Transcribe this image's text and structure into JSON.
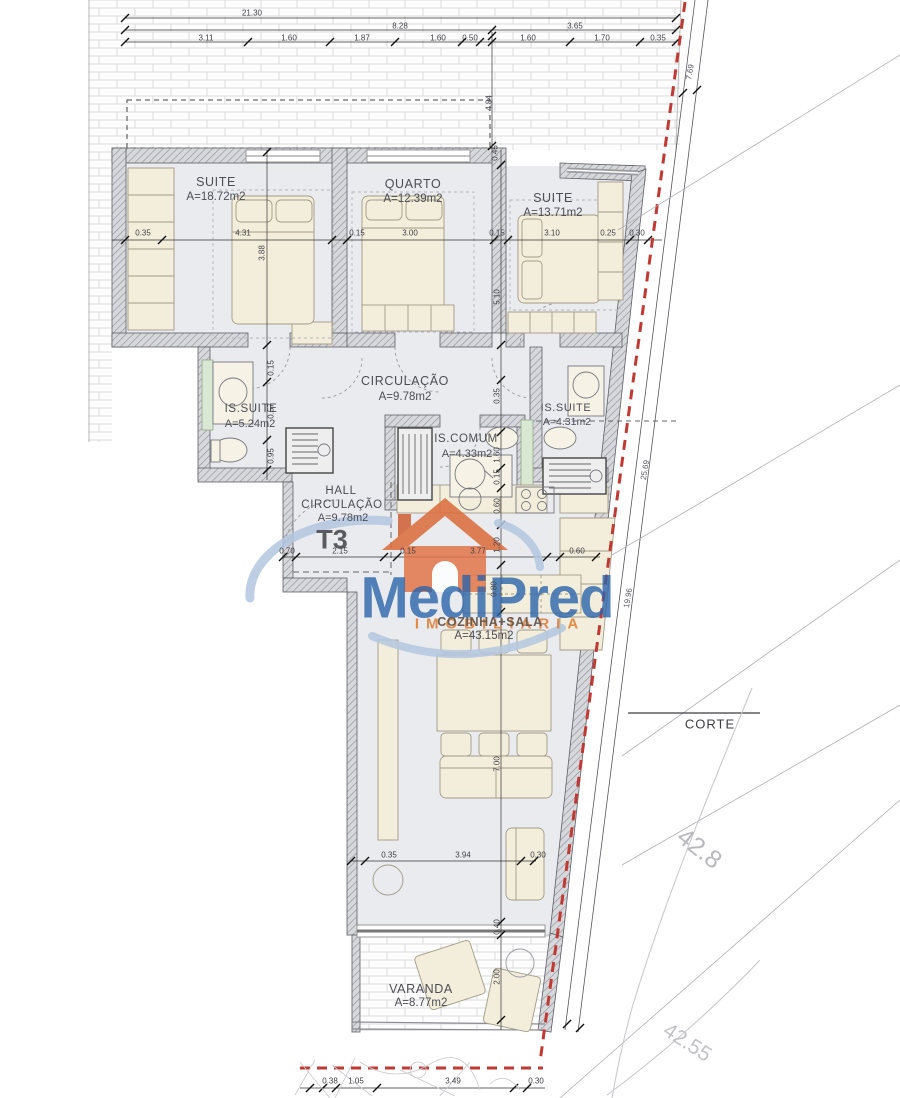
{
  "logo": {
    "name": "MediPred",
    "subtitle": "IMOBILIARIA"
  },
  "rooms": {
    "suite1": {
      "name": "SUITE",
      "area": "A=18.72m2"
    },
    "quarto": {
      "name": "QUARTO",
      "area": "A=12.39m2"
    },
    "suite2": {
      "name": "SUITE",
      "area": "A=13.71m2"
    },
    "circulacao": {
      "name": "CIRCULAÇÃO",
      "area": "A=9.78m2"
    },
    "is_suite1": {
      "name": "IS.SUITE",
      "area": "A=5.24m2"
    },
    "is_comum": {
      "name": "IS.COMUM",
      "area": "A=4.33m2"
    },
    "is_suite2": {
      "name": "IS.SUITE",
      "area": "A=4.31m2"
    },
    "hall": {
      "line1": "HALL",
      "line2": "CIRCULAÇÃO",
      "area": "A=9.78m2",
      "type": "T3"
    },
    "cozinha": {
      "name": "COZINHA+SALA",
      "area": "A=43.15m2"
    },
    "varanda": {
      "name": "VARANDA",
      "area": "A=8.77m2"
    }
  },
  "dims": {
    "t1": "21.30",
    "t2": "8.28",
    "t3": "3.65",
    "r1": [
      "3.11",
      "1.60",
      "1.87",
      "1.60",
      "0.50",
      "1.60",
      "1.70",
      "0.35"
    ],
    "v1": "4.84",
    "v2": "0.45",
    "bed": [
      "0.35",
      "4.31",
      "0.15",
      "3.00",
      "0.15",
      "3.10",
      "0.25",
      "0.30"
    ],
    "bh1": "3.88",
    "bh2": "5.10",
    "lv": [
      "0.15",
      "0.57",
      "0.95"
    ],
    "rv": [
      "0.35",
      "1.60",
      "0.15",
      "0.60",
      "1.20",
      "0.80",
      "7.00",
      "0.40",
      "2.00"
    ],
    "hall": [
      "0.70",
      "2.15",
      "0.15",
      "3.77",
      "0.60"
    ],
    "liv": [
      "0.35",
      "3.94",
      "0.30"
    ],
    "bot": [
      "0.38",
      "1.05",
      "3.49",
      "0.30"
    ]
  },
  "site": {
    "corte": "CORTE",
    "contour_a": "42.8",
    "contour_b": "42.55",
    "d1": "7.69",
    "d2": "25.69",
    "d3": "19.96",
    "boundary_color": "#c03a34",
    "accent_orange": "#e0792d",
    "accent_blue": "#2b64aa"
  }
}
